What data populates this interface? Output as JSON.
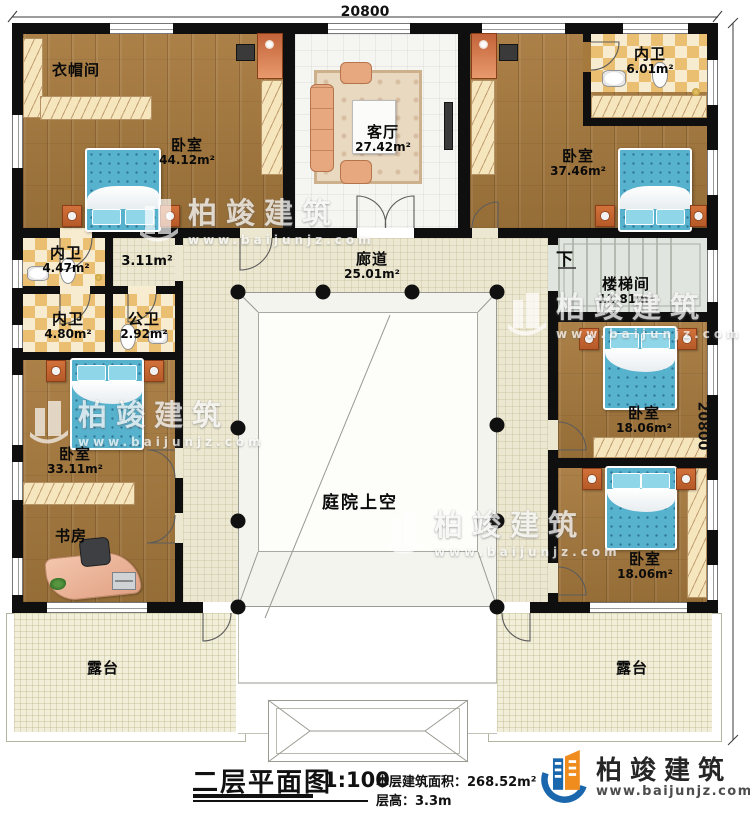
{
  "dimensions": {
    "top": "20800",
    "right": "20800"
  },
  "rooms": {
    "cloakroom": {
      "name": "衣帽间"
    },
    "bedroom_master": {
      "name": "卧室",
      "area": "44.12m²"
    },
    "living_room": {
      "name": "客厅",
      "area": "27.42m²"
    },
    "ensuite_top_right": {
      "name": "内卫",
      "area": "6.01m²"
    },
    "bedroom_top_right": {
      "name": "卧室",
      "area": "37.46m²"
    },
    "ensuite_left_upper": {
      "name": "内卫",
      "area": "4.47m²"
    },
    "hallway": {
      "area": "3.11m²"
    },
    "ensuite_left_lower": {
      "name": "内卫",
      "area": "4.80m²"
    },
    "public_bath": {
      "name": "公卫",
      "area": "2.92m²"
    },
    "corridor": {
      "name": "廊道",
      "area": "25.01m²"
    },
    "stairwell": {
      "name": "楼梯间",
      "area": "11.81m²",
      "direction": "下"
    },
    "bedroom_left": {
      "name": "卧室",
      "area": "33.11m²"
    },
    "study": {
      "name": "书房"
    },
    "bedroom_right_upper": {
      "name": "卧室",
      "area": "18.06m²"
    },
    "bedroom_right_lower": {
      "name": "卧室",
      "area": "18.06m²"
    },
    "courtyard": {
      "name": "庭院上空"
    },
    "terrace_left": {
      "name": "露台"
    },
    "terrace_right": {
      "name": "露台"
    }
  },
  "title_block": {
    "title": "二层平面图",
    "scale": "1:100",
    "floor_area": "本层建筑面积：268.52m²",
    "floor_height": "层高：3.3m"
  },
  "branding": {
    "company": "柏竣建筑",
    "website": "www.baijunjz.com"
  },
  "colors": {
    "wall": "#0f0f0f",
    "wood": "#a6793d",
    "corridor": "#ebe7d1",
    "terrace": "#f1eeda",
    "bath_checker": "#eabf72",
    "bed": "#57b2ce",
    "stair": "#e1e5df",
    "logo_blue": "#1b67ad",
    "logo_orange": "#f08c1e"
  }
}
